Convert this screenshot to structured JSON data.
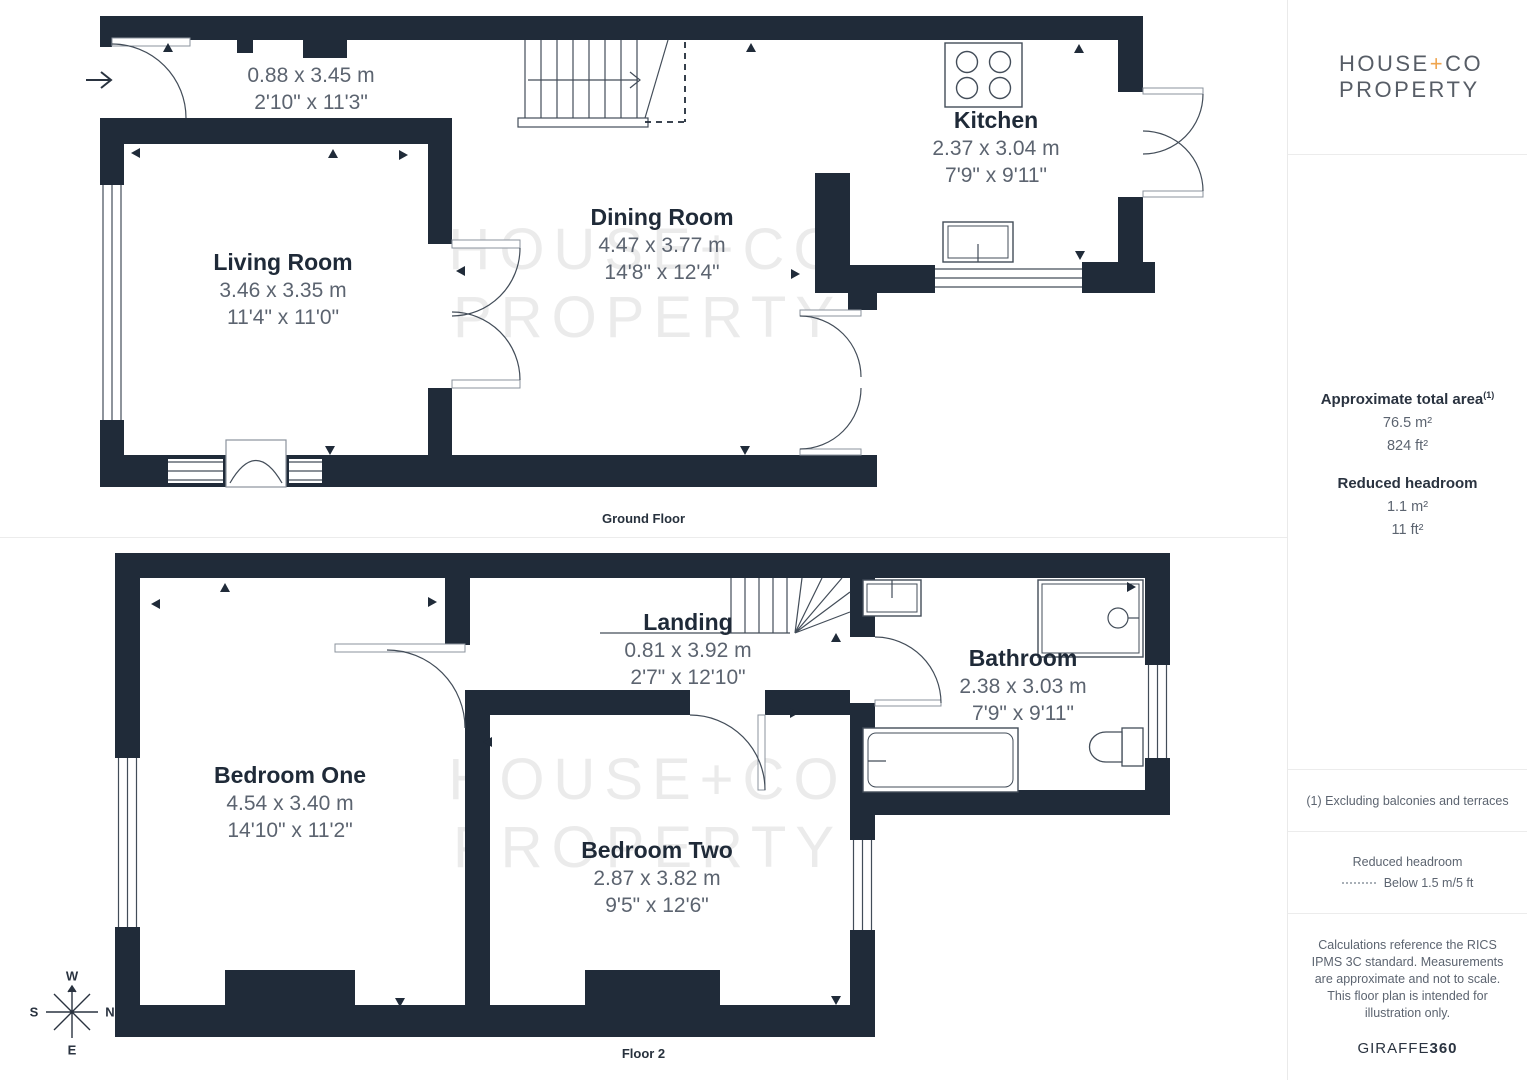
{
  "branding": {
    "line1_pre": "HOUSE",
    "plus": "+",
    "line1_post": "CO",
    "line2": "PROPERTY"
  },
  "watermark": {
    "line1": "HOUSE+CO",
    "line2": "PROPERTY"
  },
  "floors": {
    "ground": {
      "label": "Ground Floor"
    },
    "second": {
      "label": "Floor 2"
    }
  },
  "rooms": {
    "hall": {
      "metric": "0.88 x 3.45 m",
      "imperial": "2'10\" x 11'3\""
    },
    "living": {
      "name": "Living Room",
      "metric": "3.46 x 3.35 m",
      "imperial": "11'4\" x 11'0\""
    },
    "dining": {
      "name": "Dining Room",
      "metric": "4.47 x 3.77 m",
      "imperial": "14'8\" x 12'4\""
    },
    "kitchen": {
      "name": "Kitchen",
      "metric": "2.37 x 3.04 m",
      "imperial": "7'9\" x 9'11\""
    },
    "bedroom_one": {
      "name": "Bedroom One",
      "metric": "4.54 x 3.40 m",
      "imperial": "14'10\" x 11'2\""
    },
    "landing": {
      "name": "Landing",
      "metric": "0.81 x 3.92 m",
      "imperial": "2'7\" x 12'10\""
    },
    "bathroom": {
      "name": "Bathroom",
      "metric": "2.38 x 3.03 m",
      "imperial": "7'9\" x 9'11\""
    },
    "bedroom_two": {
      "name": "Bedroom Two",
      "metric": "2.87 x 3.82 m",
      "imperial": "9'5\" x 12'6\""
    }
  },
  "compass": {
    "top": "W",
    "left": "S",
    "right": "N",
    "bottom": "E"
  },
  "sidebar": {
    "total_area_label": "Approximate total area",
    "total_area_sup": "(1)",
    "total_area_metric": "76.5 m²",
    "total_area_imperial": "824 ft²",
    "reduced_label": "Reduced headroom",
    "reduced_metric": "1.1 m²",
    "reduced_imperial": "11 ft²",
    "footnote": "(1) Excluding balconies and terraces",
    "legend_title": "Reduced headroom",
    "legend_item": "Below 1.5 m/5 ft",
    "disclaimer": "Calculations reference the RICS IPMS 3C standard. Measurements are approximate and not to scale. This floor plan is intended for illustration only.",
    "brand_regular": "GIRAFFE",
    "brand_bold": "360"
  },
  "colors": {
    "wall": "#202b39",
    "accent": "#efa54f",
    "room_name": "#1f2a38",
    "dim_text": "#5c6470",
    "watermark": "#ebebeb"
  }
}
